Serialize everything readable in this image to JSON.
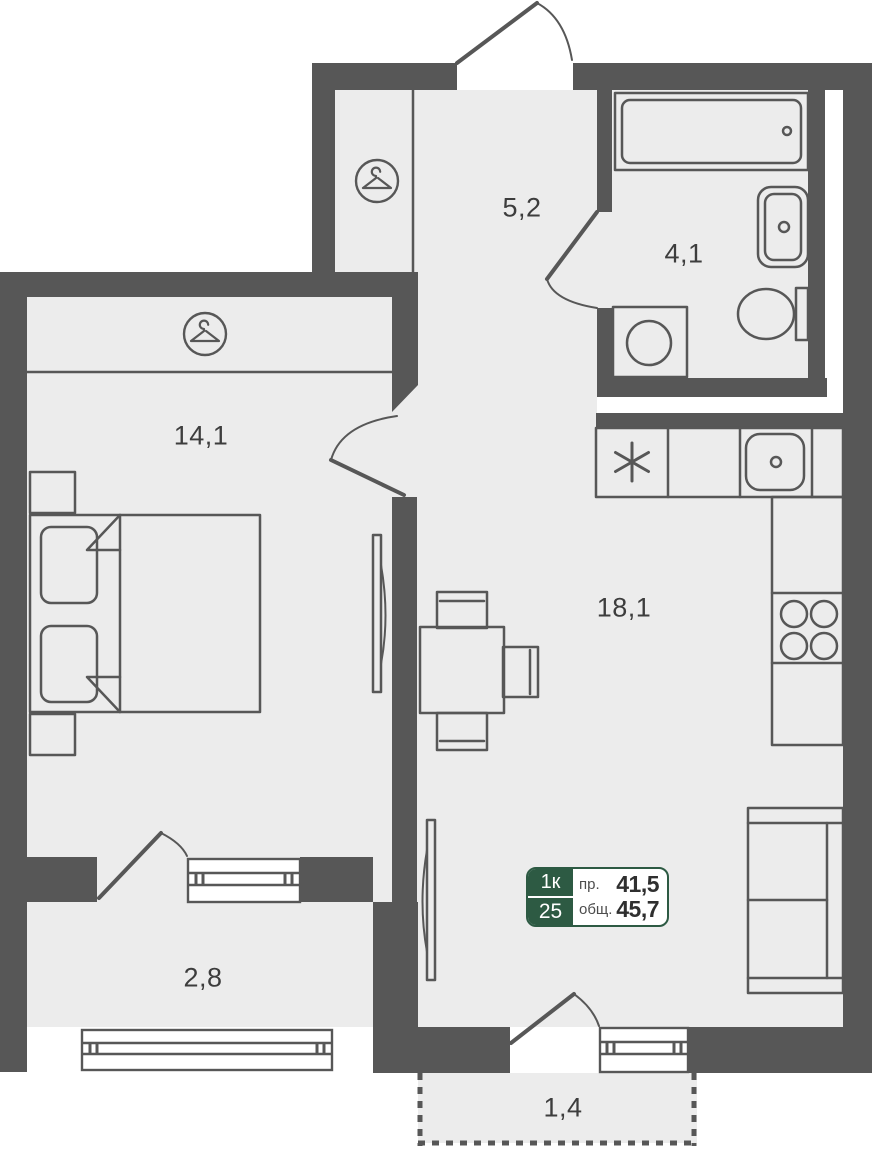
{
  "floorplan": {
    "background": "#ffffff",
    "colors": {
      "wall": "#575757",
      "floor": "#ececec",
      "furniture_outline": "#575757",
      "badge_green": "#2d5a43",
      "label_text": "#3d3d3d"
    },
    "rooms": [
      {
        "id": "hallway",
        "area": "5,2"
      },
      {
        "id": "bathroom",
        "area": "4,1"
      },
      {
        "id": "bedroom",
        "area": "14,1"
      },
      {
        "id": "kitchen-living",
        "area": "18,1"
      },
      {
        "id": "balcony",
        "area": "2,8"
      },
      {
        "id": "porch",
        "area": "1,4"
      }
    ],
    "badge": {
      "rooms_count": "1к",
      "number": "25",
      "project_area_label": "пр.",
      "project_area_value": "41,5",
      "total_area_label": "общ.",
      "total_area_value": "45,7"
    },
    "icons": {
      "wardrobe": "hanger-icon",
      "fridge": "fridge-asterisk-icon"
    }
  }
}
